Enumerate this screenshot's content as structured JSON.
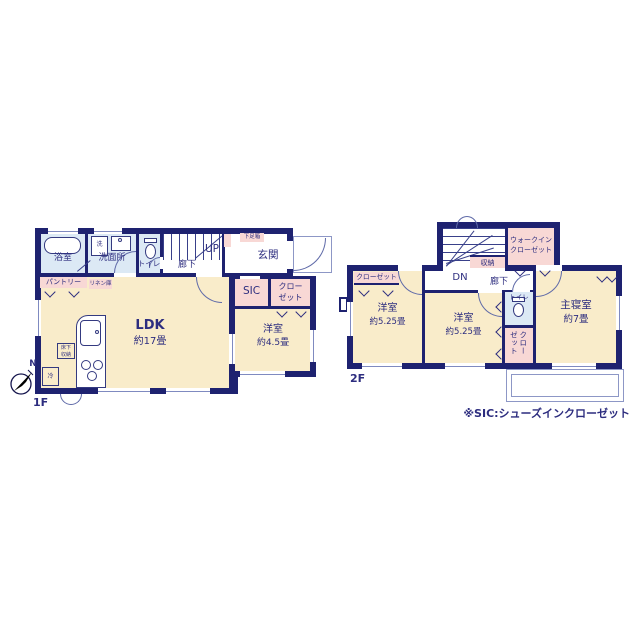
{
  "colors": {
    "wall": "#1E2270",
    "room_cream": "#F9ECCA",
    "accent_pink": "#F8D8D5",
    "wet_area_blue": "#DCE9F5",
    "text_navy": "#2D2D7F"
  },
  "compass": {
    "north": "N"
  },
  "note": "※SIC:シューズインクローゼット",
  "floor1": {
    "label": "1F",
    "bath": "浴室",
    "washer": "洗",
    "washroom": "洗面所",
    "toilet": "トイレ",
    "hallway": "廊下",
    "stairs": "UP",
    "shoe_box": "下足箱",
    "entrance": "玄関",
    "pantry": "パントリー",
    "linen": "リネン庫",
    "ldk": "LDK",
    "ldk_size": "約17畳",
    "underfloor_storage": "床下収納",
    "fridge": "冷",
    "sic": "SIC",
    "closet": "クローゼット",
    "western_room": "洋室",
    "western_room_size": "約4.5畳"
  },
  "floor2": {
    "label": "2F",
    "stairs": "DN",
    "hallway": "廊下",
    "storage": "収納",
    "walk_in_closet": "ウォークインクローゼット",
    "closet_left": "クローゼット",
    "western_room_1": "洋室",
    "western_room_1_size": "約5.25畳",
    "western_room_2": "洋室",
    "western_room_2_size": "約5.25畳",
    "toilet": "トイレ",
    "closet_master": "クローゼット",
    "master_bedroom": "主寝室",
    "master_bedroom_size": "約7畳"
  }
}
